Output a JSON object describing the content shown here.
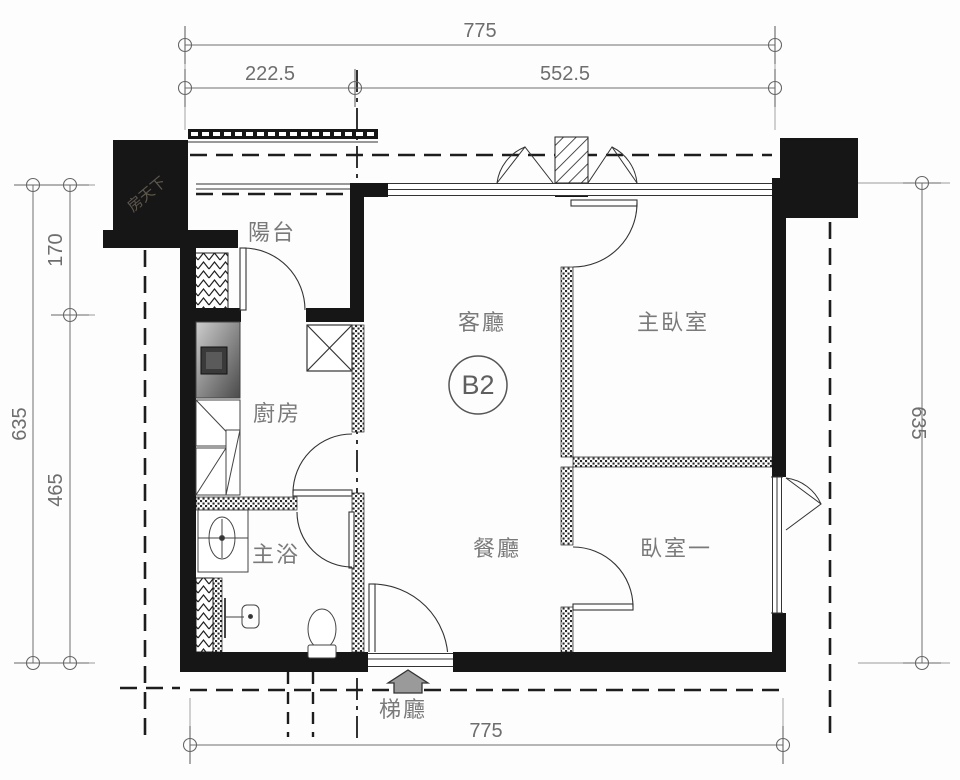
{
  "plan": {
    "unit_badge": "B2",
    "rooms": {
      "balcony": "陽台",
      "living": "客廳",
      "master_bedroom": "主臥室",
      "kitchen": "廚房",
      "master_bath": "主浴",
      "dining": "餐廳",
      "bedroom_one": "臥室一",
      "stair_hall": "梯廳"
    },
    "dimensions": {
      "top_overall": "775",
      "top_seg_left": "222.5",
      "top_seg_right": "552.5",
      "left_overall": "635",
      "left_seg_top": "170",
      "left_seg_bottom": "465",
      "right_overall": "635",
      "bottom_overall": "775"
    },
    "watermark": "房天下",
    "colors": {
      "wall": "#161616",
      "dimension_lines": "#6e6e6e",
      "room_labels": "#7a7a7a",
      "paper": "#fdfdfd"
    }
  }
}
